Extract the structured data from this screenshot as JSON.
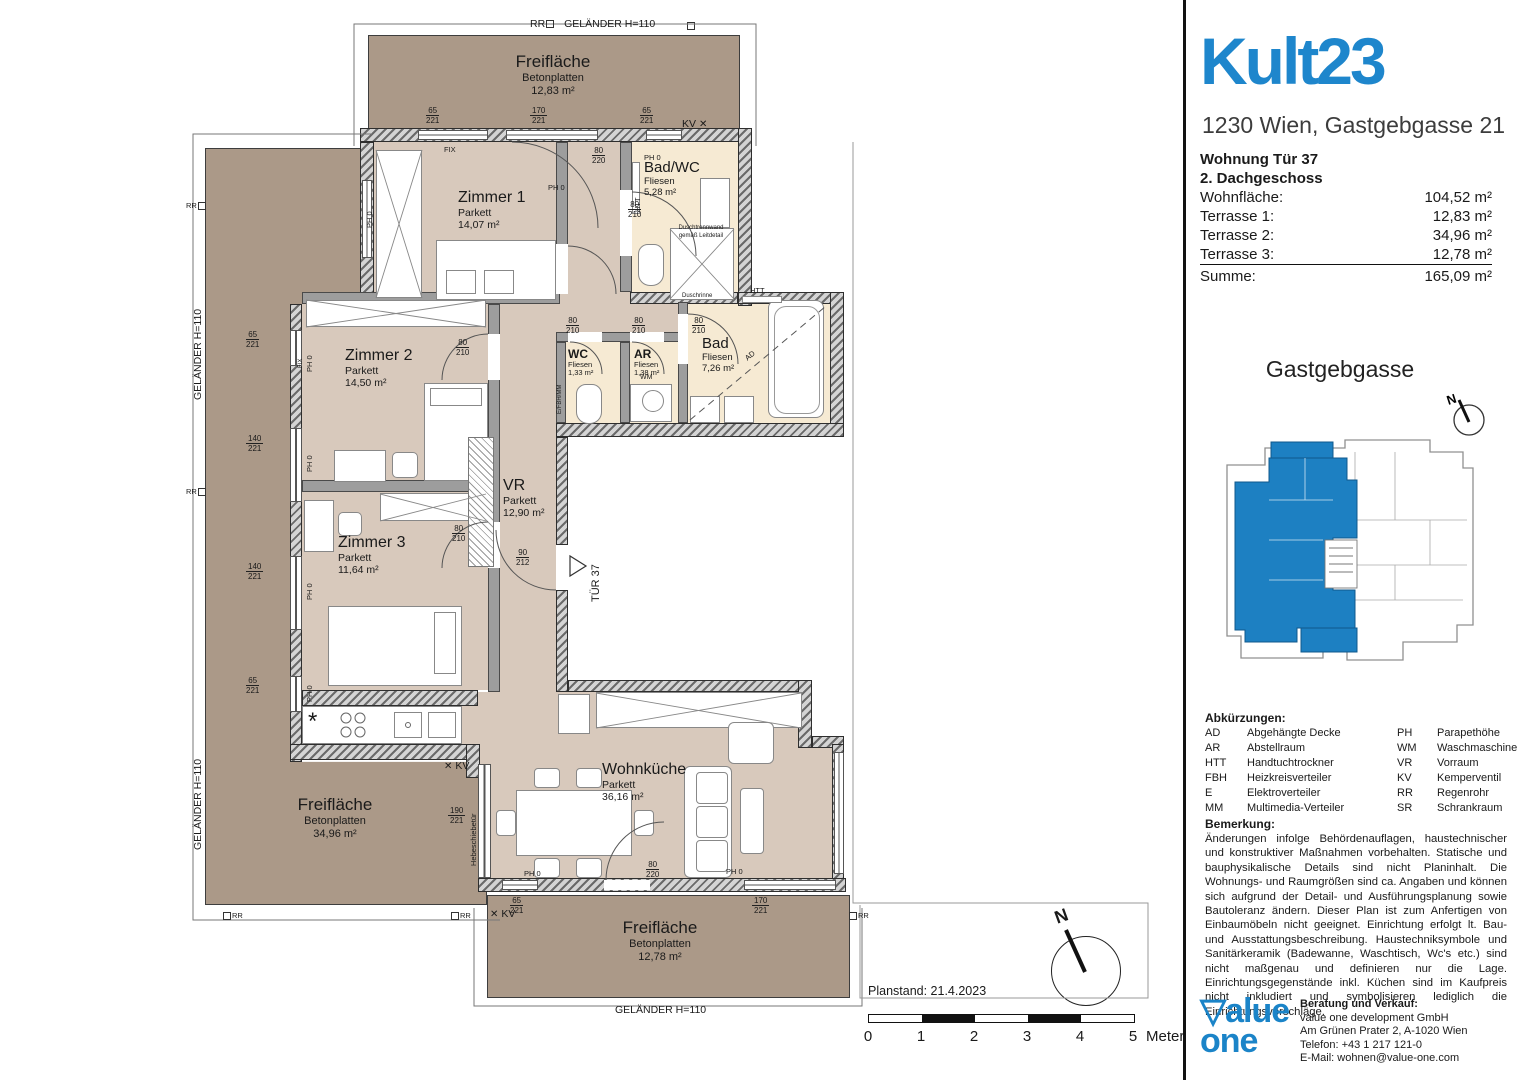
{
  "panel": {
    "header": {
      "title": "Kult23",
      "address": "1230 Wien, Gastgebgasse 21"
    },
    "unit": {
      "line1": "Wohnung Tür 37",
      "line2": "2. Dachgeschoss",
      "rows": [
        {
          "label": "Wohnfläche:",
          "value": "104,52 m²"
        },
        {
          "label": "Terrasse 1:",
          "value": "12,83 m²"
        },
        {
          "label": "Terrasse 2:",
          "value": "34,96 m²"
        },
        {
          "label": "Terrasse 3:",
          "value": "12,78 m²"
        },
        {
          "label": "Summe:",
          "value": "165,09 m²"
        }
      ]
    },
    "site": {
      "title": "Gastgebgasse",
      "north": "N"
    },
    "abbreviations": {
      "title": "Abkürzungen:",
      "rows": [
        {
          "a1": "AD",
          "l1": "Abgehängte Decke",
          "a2": "PH",
          "l2": "Parapethöhe"
        },
        {
          "a1": "AR",
          "l1": "Abstellraum",
          "a2": "WM",
          "l2": "Waschmaschine"
        },
        {
          "a1": "HTT",
          "l1": "Handtuchtrockner",
          "a2": "VR",
          "l2": "Vorraum"
        },
        {
          "a1": "FBH",
          "l1": "Heizkreisverteiler",
          "a2": "KV",
          "l2": "Kemperventil"
        },
        {
          "a1": "E",
          "l1": "Elektroverteiler",
          "a2": "RR",
          "l2": "Regenrohr"
        },
        {
          "a1": "MM",
          "l1": "Multimedia-Verteiler",
          "a2": "SR",
          "l2": "Schrankraum"
        }
      ]
    },
    "remark": {
      "title": "Bemerkung:",
      "text": "Änderungen infolge Behördenauflagen, haustechnischer und konstruktiver Maßnahmen vorbehalten. Statische und bauphysikalische Details sind nicht Planinhalt. Die Wohnungs- und Raumgrößen sind ca. Angaben und können sich aufgrund der Detail- und Ausführungsplanung sowie Bautoleranz ändern. Dieser Plan ist zum Anfertigen von Einbaumöbeln nicht geeignet. Einrichtung erfolgt lt. Bau- und Ausstattungsbeschreibung. Haustechniksymbole und Sanitärkeramik (Badewanne, Waschtisch, Wc's etc.) sind nicht maßgenau und definieren nur die Lage. Einrichtungsgegenstände inkl. Küchen sind im Kaufpreis nicht inkludiert und symbolisieren lediglich die  Einrichtungsvorschläge."
    },
    "footer": {
      "logo_line1": "▽alue",
      "logo_line2": "one",
      "contact_title": "Beratung und Verkauf:",
      "lines": [
        "value one development GmbH",
        "Am Grünen Prater 2, A-1020 Wien",
        "Telefon: +43 1 217 121-0",
        "E-Mail:  wohnen@value-one.com"
      ]
    }
  },
  "plan": {
    "rooms": [
      {
        "name": "Zimmer 1",
        "floor": "Parkett",
        "area": "14,07 m²"
      },
      {
        "name": "Bad/WC",
        "floor": "Fliesen",
        "area": "5,28 m²"
      },
      {
        "name": "Zimmer 2",
        "floor": "Parkett",
        "area": "14,50 m²"
      },
      {
        "name": "Zimmer 3",
        "floor": "Parkett",
        "area": "11,64 m²"
      },
      {
        "name": "VR",
        "floor": "Parkett",
        "area": "12,90 m²"
      },
      {
        "name": "WC",
        "floor": "Fliesen",
        "area": "1,33 m²"
      },
      {
        "name": "AR",
        "floor": "Fliesen",
        "area": "1,38 m²"
      },
      {
        "name": "Bad",
        "floor": "Fliesen",
        "area": "7,26 m²"
      },
      {
        "name": "Wohnküche",
        "floor": "Parkett",
        "area": "36,16 m²"
      }
    ],
    "terraces": [
      {
        "name": "Freifläche",
        "material": "Betonplatten",
        "area": "12,83 m²"
      },
      {
        "name": "Freifläche",
        "material": "Betonplatten",
        "area": "34,96 m²"
      },
      {
        "name": "Freifläche",
        "material": "Betonplatten",
        "area": "12,78 m²"
      }
    ],
    "labels": {
      "railing": "GELÄNDER H=110",
      "rr": "RR",
      "kv": "KV",
      "ph0": "PH 0",
      "fix": "FIX",
      "tuer": "TÜR 37",
      "htt": "HTT",
      "wm": "WM",
      "ad": "AD",
      "dusch1": "Duschtrennwand",
      "dusch2": "gemäß Leitdetail",
      "duschrinne": "Duschrinne",
      "hebe": "Hebeschiebetür",
      "efbhmm": "E/FBH/MM"
    },
    "icons": {
      "kv_cross": "✕",
      "burner": "*"
    },
    "dims": {
      "d65_221": {
        "n": "65",
        "d": "221"
      },
      "d170_221": {
        "n": "170",
        "d": "221"
      },
      "d140_221": {
        "n": "140",
        "d": "221"
      },
      "d80_210": {
        "n": "80",
        "d": "210"
      },
      "d80_220": {
        "n": "80",
        "d": "220"
      },
      "d90_212": {
        "n": "90",
        "d": "212"
      },
      "d190_221": {
        "n": "190",
        "d": "221"
      }
    },
    "planstand": "Planstand: 21.4.2023",
    "scalebar": {
      "ticks": [
        "0",
        "1",
        "2",
        "3",
        "4",
        "5"
      ],
      "unit": "Meter"
    },
    "north": "N"
  }
}
